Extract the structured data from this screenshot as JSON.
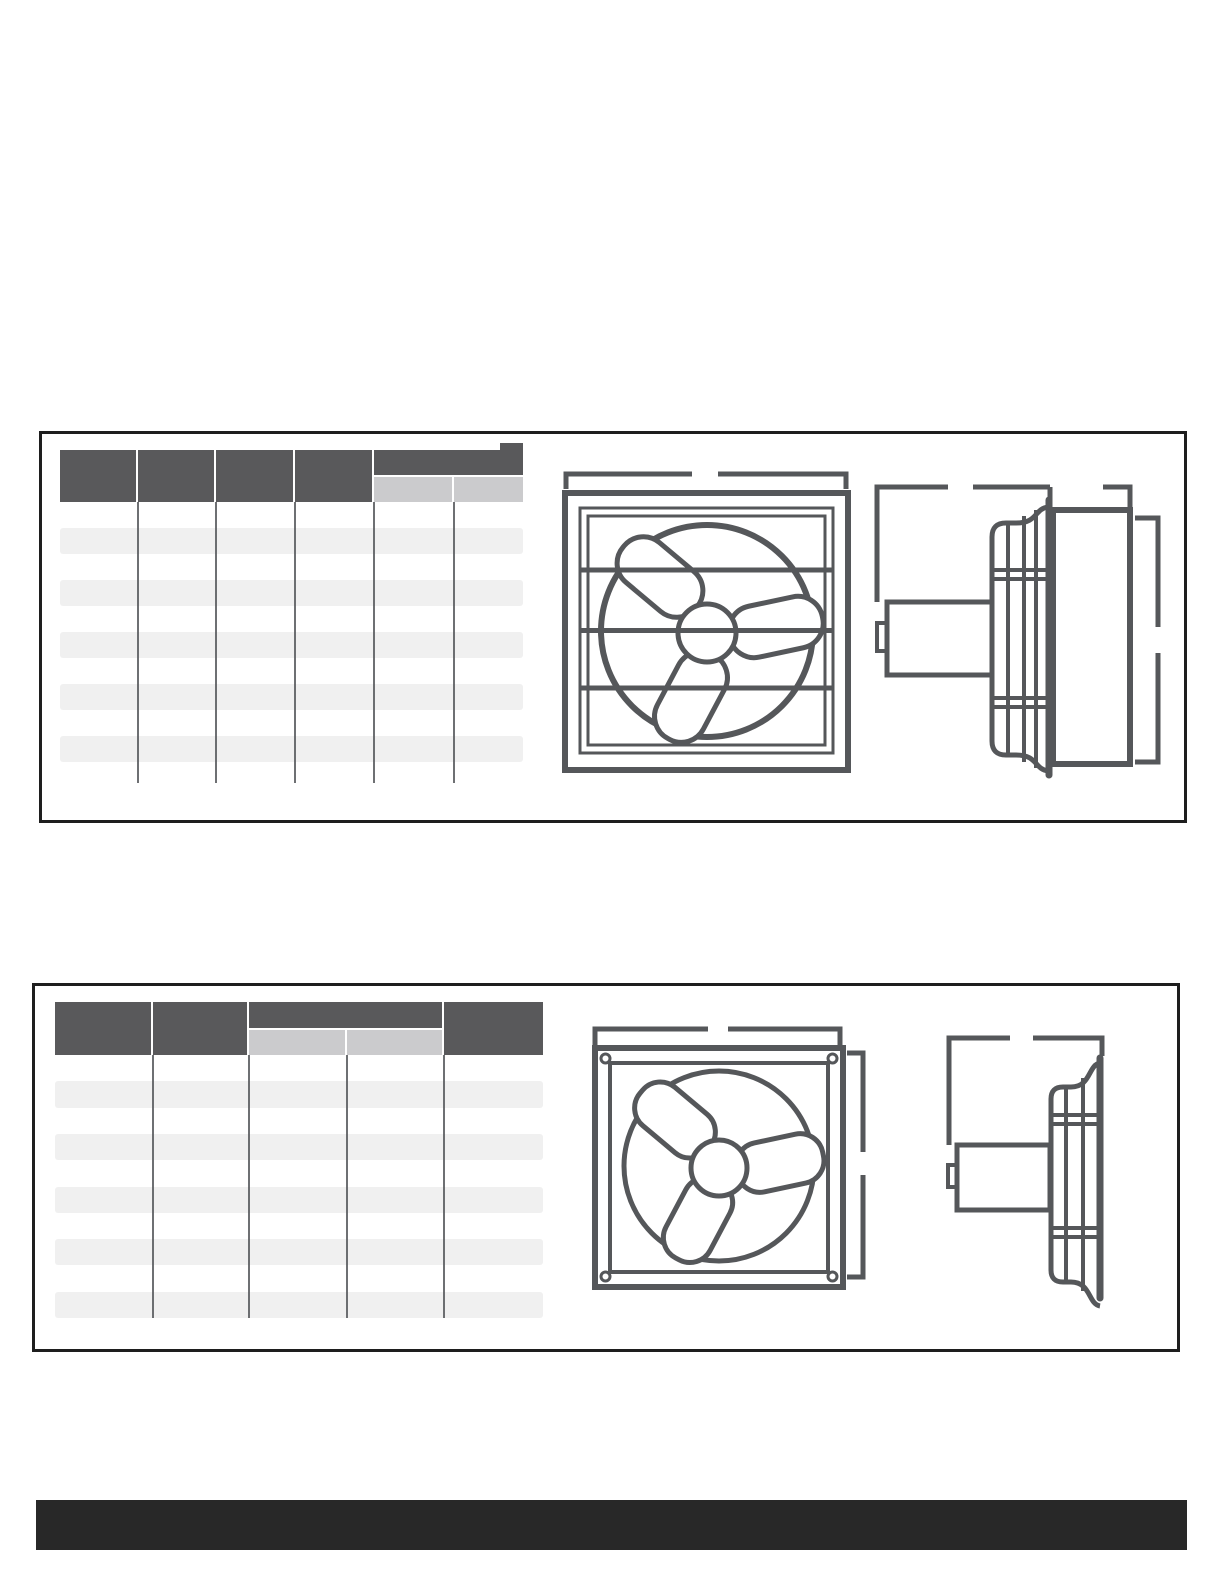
{
  "page": {
    "width": 1224,
    "height": 1584,
    "background": "#ffffff"
  },
  "colors": {
    "box_border": "#1e1e1e",
    "table_header_dark": "#59595b",
    "table_subheader_light": "#cbcbcd",
    "table_row_alt": "#f0f0f0",
    "table_divider": "#55575a",
    "drawing_stroke": "#55575a",
    "footer_bar": "#282828"
  },
  "sections": [
    {
      "name": "product-spec-panel-1",
      "table": {
        "name": "spec-table-1",
        "x": 60,
        "y": 450,
        "header_h": 52,
        "columns": [
          78,
          78,
          79,
          79,
          80,
          69
        ],
        "group": {
          "start": 4,
          "end": 5,
          "top_h": 25
        },
        "tab": {
          "dx": 440,
          "dy": -7,
          "w": 23,
          "h": 8
        },
        "rows": 10,
        "row_h": 26,
        "line_overhang": 21
      },
      "drawings": [
        "shutter-exhaust-fan-front-view",
        "shutter-exhaust-fan-side-view"
      ]
    },
    {
      "name": "product-spec-panel-2",
      "table": {
        "name": "spec-table-2",
        "x": 55,
        "y": 1002,
        "header_h": 53,
        "columns": [
          98,
          96,
          98,
          97,
          99
        ],
        "group": {
          "start": 2,
          "end": 3,
          "top_h": 26
        },
        "rows": 10,
        "row_h": 26.3,
        "line_overhang": 0
      },
      "drawings": [
        "plate-mount-fan-front-view",
        "plate-mount-fan-side-view"
      ]
    }
  ],
  "footer": {
    "x": 36,
    "y": 1500,
    "width": 1151,
    "height": 50
  }
}
